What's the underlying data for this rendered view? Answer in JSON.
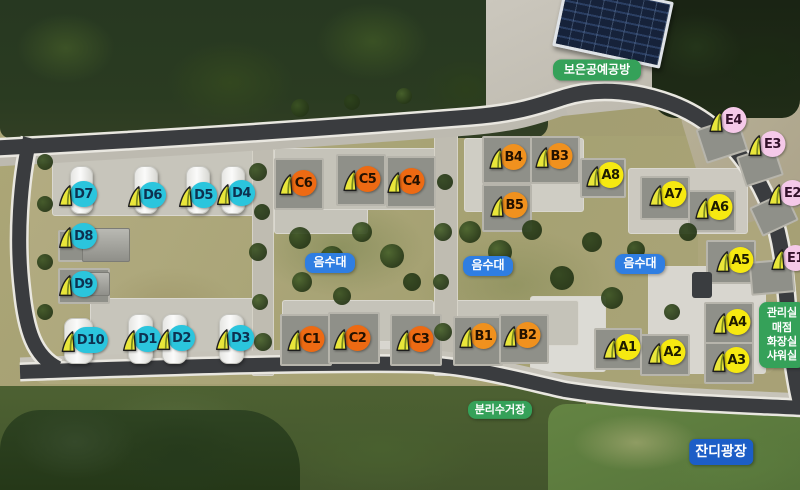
{
  "map_title": "캠핑장 항공 배치도",
  "group_colors": {
    "A": {
      "fill": "#f6e911",
      "text": "#1e1c00"
    },
    "B": {
      "fill": "#f0911e",
      "text": "#231100"
    },
    "C": {
      "fill": "#ed6a13",
      "text": "#231100"
    },
    "D": {
      "fill": "#2bc5dd",
      "text": "#0d3150"
    },
    "E": {
      "fill": "#f5c9e9",
      "text": "#33112b"
    }
  },
  "sites": [
    {
      "label": "D7",
      "group": "D",
      "x": 77,
      "y": 194
    },
    {
      "label": "D6",
      "group": "D",
      "x": 146,
      "y": 195
    },
    {
      "label": "D5",
      "group": "D",
      "x": 197,
      "y": 195
    },
    {
      "label": "D4",
      "group": "D",
      "x": 235,
      "y": 193
    },
    {
      "label": "D8",
      "group": "D",
      "x": 77,
      "y": 236
    },
    {
      "label": "D9",
      "group": "D",
      "x": 77,
      "y": 284
    },
    {
      "label": "D10",
      "group": "D",
      "x": 84,
      "y": 340
    },
    {
      "label": "D1",
      "group": "D",
      "x": 141,
      "y": 339
    },
    {
      "label": "D2",
      "group": "D",
      "x": 175,
      "y": 338
    },
    {
      "label": "D3",
      "group": "D",
      "x": 234,
      "y": 338
    },
    {
      "label": "C6",
      "group": "C",
      "x": 297,
      "y": 183
    },
    {
      "label": "C5",
      "group": "C",
      "x": 361,
      "y": 179
    },
    {
      "label": "C4",
      "group": "C",
      "x": 405,
      "y": 181
    },
    {
      "label": "C1",
      "group": "C",
      "x": 305,
      "y": 339
    },
    {
      "label": "C2",
      "group": "C",
      "x": 351,
      "y": 338
    },
    {
      "label": "C3",
      "group": "C",
      "x": 414,
      "y": 339
    },
    {
      "label": "B4",
      "group": "B",
      "x": 507,
      "y": 157
    },
    {
      "label": "B3",
      "group": "B",
      "x": 553,
      "y": 156
    },
    {
      "label": "B5",
      "group": "B",
      "x": 508,
      "y": 205
    },
    {
      "label": "B1",
      "group": "B",
      "x": 477,
      "y": 336
    },
    {
      "label": "B2",
      "group": "B",
      "x": 521,
      "y": 335
    },
    {
      "label": "A8",
      "group": "A",
      "x": 604,
      "y": 175
    },
    {
      "label": "A7",
      "group": "A",
      "x": 667,
      "y": 194
    },
    {
      "label": "A6",
      "group": "A",
      "x": 713,
      "y": 207
    },
    {
      "label": "A5",
      "group": "A",
      "x": 734,
      "y": 260
    },
    {
      "label": "A4",
      "group": "A",
      "x": 731,
      "y": 322
    },
    {
      "label": "A1",
      "group": "A",
      "x": 621,
      "y": 347
    },
    {
      "label": "A2",
      "group": "A",
      "x": 666,
      "y": 352
    },
    {
      "label": "A3",
      "group": "A",
      "x": 730,
      "y": 360
    },
    {
      "label": "E4",
      "group": "E",
      "x": 727,
      "y": 120
    },
    {
      "label": "E3",
      "group": "E",
      "x": 766,
      "y": 144
    },
    {
      "label": "E2",
      "group": "E",
      "x": 786,
      "y": 193
    },
    {
      "label": "E1",
      "group": "E",
      "x": 789,
      "y": 258
    }
  ],
  "facilities": [
    {
      "id": "craft-workshop",
      "label": "보은공예공방",
      "style": "green",
      "x": 597,
      "y": 70,
      "w": 88,
      "h": 21,
      "fs": 12
    },
    {
      "id": "water-station-1",
      "label": "음수대",
      "style": "blue",
      "x": 330,
      "y": 263,
      "w": 50,
      "h": 20,
      "fs": 12
    },
    {
      "id": "water-station-2",
      "label": "음수대",
      "style": "blue",
      "x": 488,
      "y": 266,
      "w": 50,
      "h": 20,
      "fs": 12
    },
    {
      "id": "water-station-3",
      "label": "음수대",
      "style": "blue",
      "x": 640,
      "y": 264,
      "w": 50,
      "h": 20,
      "fs": 12
    },
    {
      "id": "recycling-station",
      "label": "분리수거장",
      "style": "green",
      "x": 500,
      "y": 410,
      "w": 64,
      "h": 18,
      "fs": 11
    },
    {
      "id": "lawn-plaza",
      "label": "잔디광장",
      "style": "blue-dark",
      "x": 721,
      "y": 452,
      "w": 62,
      "h": 26,
      "fs": 14
    },
    {
      "id": "office-info",
      "label": "관리실 매점 화장실 샤워실",
      "lines": [
        "관리실",
        "매점",
        "화장실",
        "샤워실"
      ],
      "style": "green",
      "x": 782,
      "y": 335,
      "w": 46,
      "h": 66,
      "fs": 11
    }
  ]
}
